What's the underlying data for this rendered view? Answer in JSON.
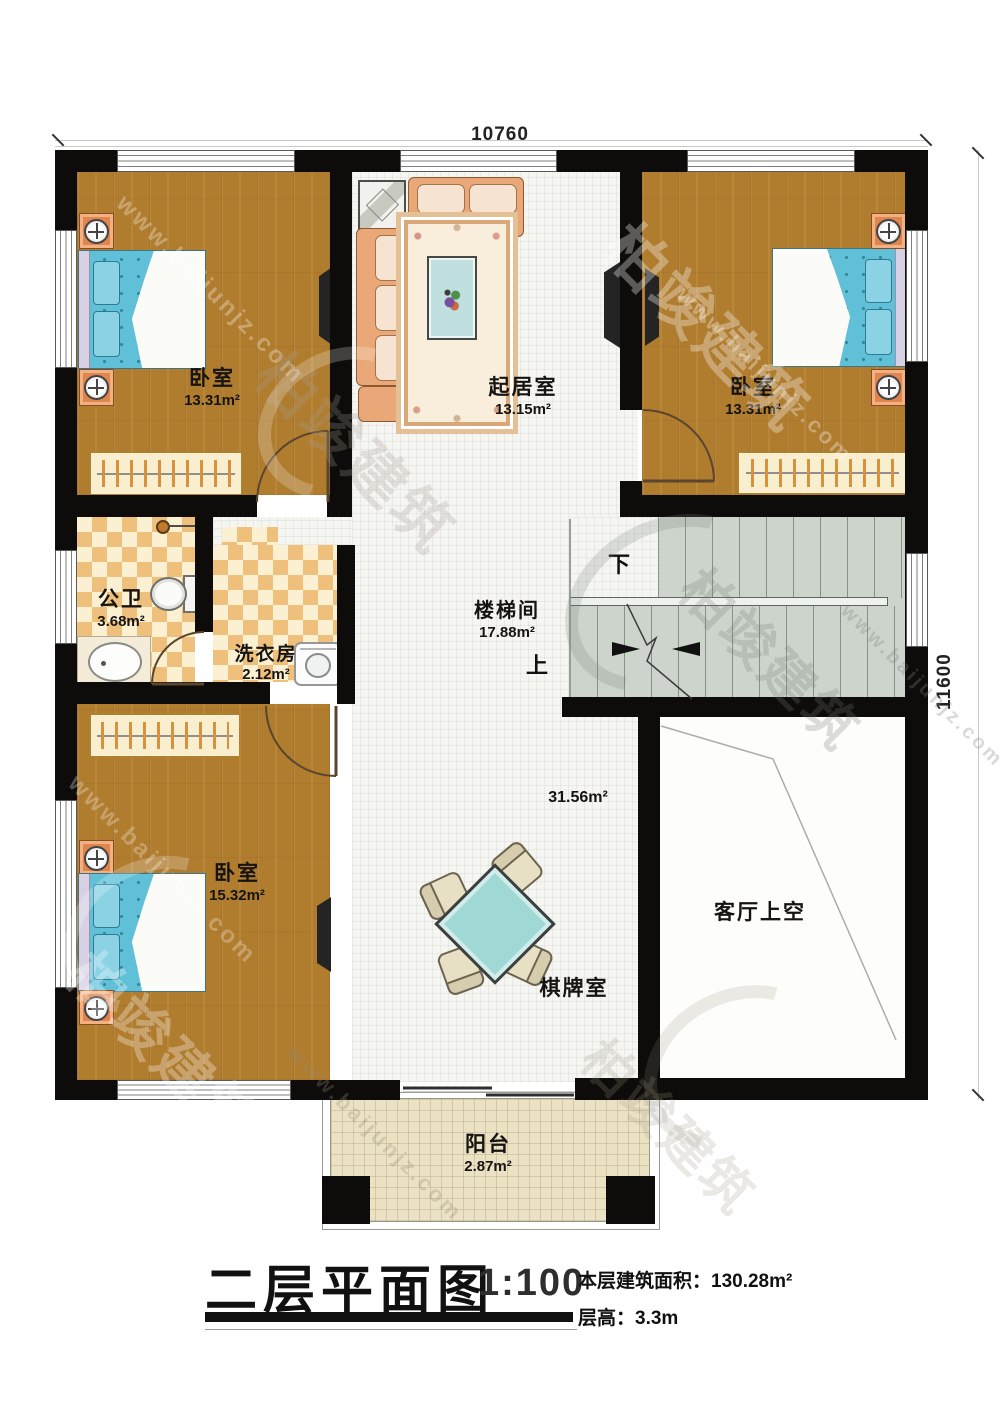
{
  "watermark": {
    "brand": "柏竣建筑",
    "url": "www.baijunjz.com"
  },
  "dimensions": {
    "top": "10760",
    "right": "11600"
  },
  "rooms": {
    "bedroom_tl": {
      "name": "卧室",
      "area": "13.31m²"
    },
    "living": {
      "name": "起居室",
      "area": "13.15m²"
    },
    "bedroom_tr": {
      "name": "卧室",
      "area": "13.31m²"
    },
    "bathroom": {
      "name": "公卫",
      "area": "3.68m²"
    },
    "laundry": {
      "name": "洗衣房",
      "area": "2.12m²"
    },
    "stairwell": {
      "name": "楼梯间",
      "area": "17.88m²",
      "down": "下",
      "up": "上"
    },
    "bedroom_bl": {
      "name": "卧室",
      "area": "15.32m²"
    },
    "gameroom": {
      "name": "棋牌室",
      "area": "31.56m²"
    },
    "void": {
      "name": "客厅上空"
    },
    "balcony": {
      "name": "阳台",
      "area": "2.87m²"
    }
  },
  "titleblock": {
    "title": "二层平面图",
    "scale": "1:100",
    "area_label": "本层建筑面积：",
    "area_value": "130.28m²",
    "floor_height_label": "层高：",
    "floor_height_value": "3.3m"
  },
  "colors": {
    "wall": "#0d0c0a",
    "wood_floor": "#b07c2e",
    "tile_floor": "#f5f5f2",
    "checker_tile": "#eec07c",
    "stair_floor": "#ccd4cb",
    "balcony_floor": "#ebe2c4",
    "bed": "#5fc0d8",
    "nightstand": "#e0854e",
    "sofa": "#eaa878",
    "game_table": "#a0d8d6"
  }
}
